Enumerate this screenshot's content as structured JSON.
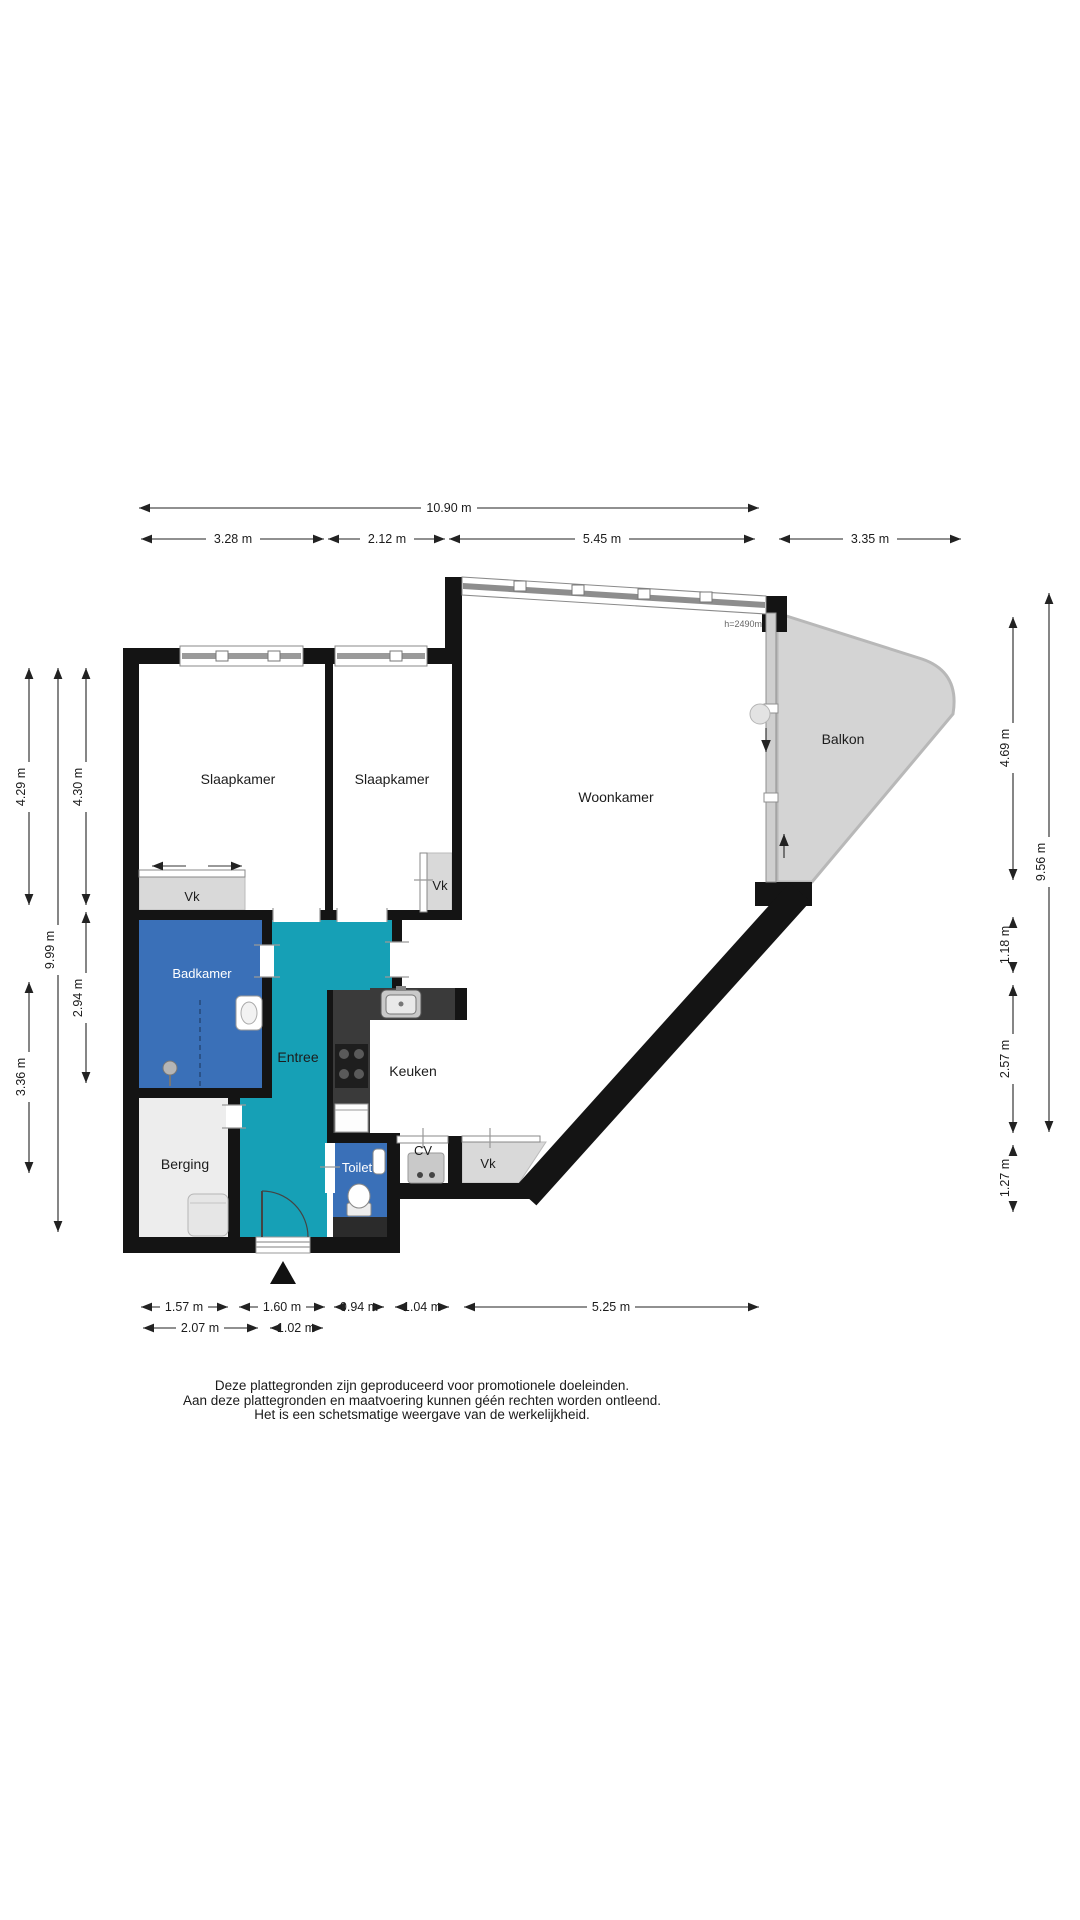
{
  "plan": {
    "rooms": {
      "slaapkamer1": "Slaapkamer",
      "slaapkamer2": "Slaapkamer",
      "woonkamer": "Woonkamer",
      "balkon": "Balkon",
      "badkamer": "Badkamer",
      "entree": "Entree",
      "keuken": "Keuken",
      "berging": "Berging",
      "toilet": "Toilet",
      "cv": "CV",
      "vk_slaapkamer1": "Vk",
      "vk_slaapkamer2": "Vk",
      "vk_keuken": "Vk"
    },
    "annotations": {
      "ceiling_height": "h=2490m"
    },
    "dimensions": {
      "top_total": "10.90 m",
      "top_segments": [
        "3.28 m",
        "2.12 m",
        "5.45 m",
        "3.35 m"
      ],
      "left": {
        "outer_top": "4.29 m",
        "outer_bottom": "3.36 m",
        "total": "9.99 m",
        "inner_top": "4.30 m",
        "inner_bottom": "2.94 m"
      },
      "right": {
        "balkon": "4.69 m",
        "seg2": "1.18 m",
        "seg3": "2.57 m",
        "seg4": "1.27 m",
        "total": "9.56 m"
      },
      "bottom_row1": [
        "1.57 m",
        "1.60 m",
        "0.94 m",
        "1.04 m",
        "5.25 m"
      ],
      "bottom_row2": [
        "2.07 m",
        "1.02 m"
      ]
    },
    "disclaimer": [
      "Deze plattegronden zijn geproduceerd voor promotionele doeleinden.",
      "Aan deze plattegronden en maatvoering kunnen géén rechten worden ontleend.",
      "Het is een schetsmatige weergave van de werkelijkheid."
    ],
    "colors": {
      "wall": "#141414",
      "entree": "#16A0B6",
      "wet_room": "#3A70B8",
      "balkon": "#D4D4D4",
      "closet": "#D9D9D9",
      "berging": "#EDEDED",
      "counter": "#3A3A3A"
    }
  }
}
